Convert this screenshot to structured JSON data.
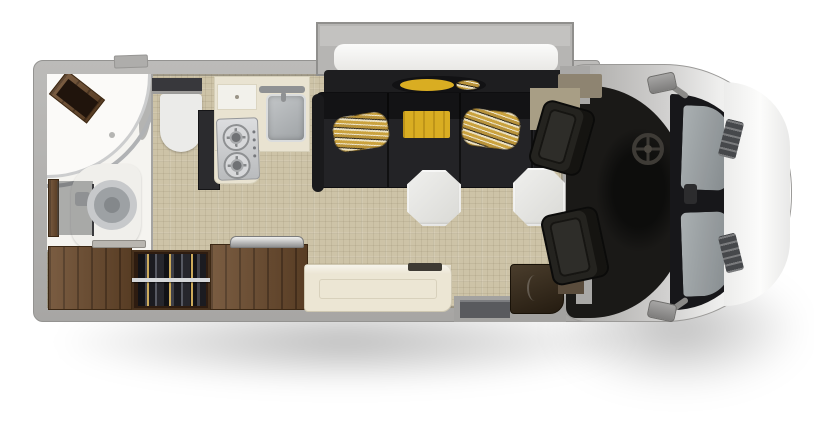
{
  "scene": {
    "type": "rv-motorhome-floorplan-top-view",
    "background": "#ffffff",
    "orientation": "front cab at right, rear wet bath at left, sofa slide-out at top"
  },
  "palette": {
    "body": "#b2b1af",
    "body_edge": "#8f8e8c",
    "slide_out": "#b6b5b3",
    "floor": "#cdc3a7",
    "bath_floor": "#f5f4f0",
    "wood": "#6b4a2c",
    "wardrobe_interior": "#2e1c10",
    "counter": "#e9e3d1",
    "stainless": "#c9cbcd",
    "sofa": "#232326",
    "pillow_gold": "#c9a23c",
    "throw_yellow": "#d9ad22",
    "table": "#e7e7e3",
    "bench": "#ece6d4",
    "cab_interior": "#1a1917",
    "windshield": "#17171a",
    "glass": "#9aa0a2",
    "hood": "#f7f7f6",
    "seat": "#24231f",
    "step": "#595a5e",
    "entry_cabinet": "#3a2d1d",
    "shadow": "rgba(0,0,0,0.27)"
  },
  "objects": {
    "slide_out": "sofa slide-out box protruding from top wall",
    "sofa": "charcoal sectional sofa with two gold patterned bolster pillows and a yellow throw",
    "tables": "two white octagonal pedestal tables",
    "bench": "cream bench seat along bottom wall",
    "kitchen": "L-shaped galley: two-burner cooktop, square sink with faucet, covered prep flap, dark refrigerator column",
    "bathroom": "rear corner wet bath: quarter-round shower with glass arc and corner teak shelf, round toilet, vanity with mirror panel",
    "wardrobe": "open hanging wardrobe with clothes on rod between wood cabinets",
    "trays": "metal tray on right wood cabinet top",
    "cab": "cockpit with steering wheel, dashboard and two rear-facing swivel captain chairs",
    "entry": "entry door step well and angled corner cabinet at bottom right",
    "front_end": "van nose: dark windshield with glass panes and wipers, white hood with vents, two side mirrors"
  }
}
